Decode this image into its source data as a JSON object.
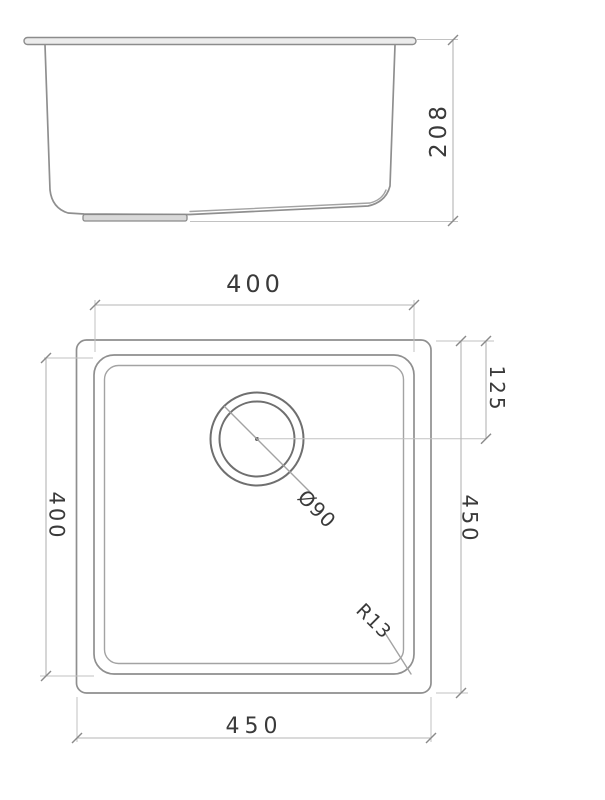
{
  "drawing": {
    "description": "Technical dimension drawing of a square undermount sink: side elevation (top) and plan view (bottom)",
    "colors": {
      "background": "#ffffff",
      "geometry_line": "#8f8f8f",
      "dimension_line": "#b5b5b5",
      "text": "#3a3a3a"
    },
    "side_view": {
      "label_height": "208"
    },
    "plan_view": {
      "label_inner_width": "400",
      "label_inner_depth": "400",
      "label_outer_width": "450",
      "label_outer_depth": "450",
      "label_drain_offset": "125",
      "label_drain_diameter": "Ø90",
      "label_corner_radius": "R13"
    }
  }
}
